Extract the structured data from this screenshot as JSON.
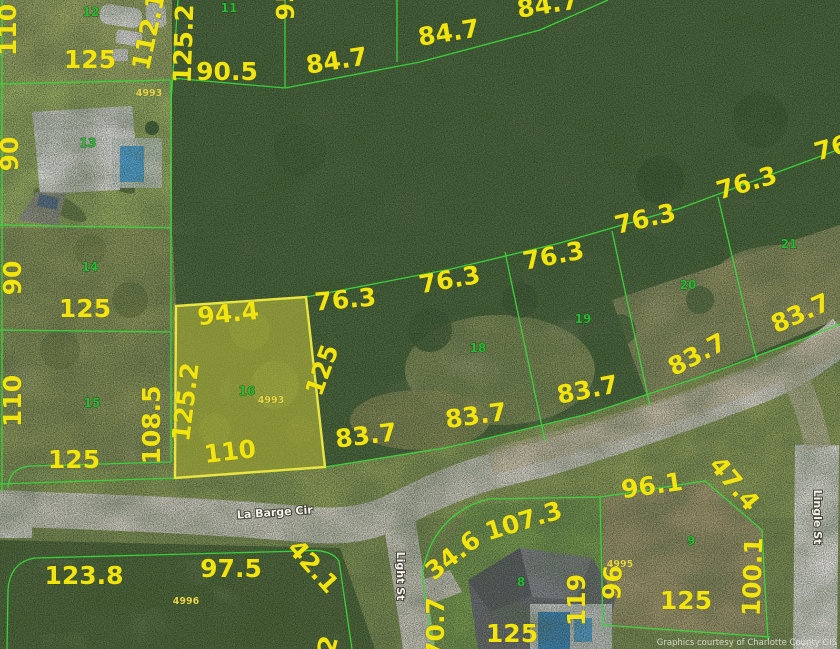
{
  "map": {
    "description": "County GIS aerial parcel map with lot dimension overlay",
    "watermark": "Graphics courtesy of Charlotte County GIS",
    "highlighted_parcel": {
      "parcel_number": "16",
      "lot_id": "4993"
    },
    "colors": {
      "boundary": "#3bd63b",
      "dimension_text": "#f2e40e",
      "lot_id_text": "#e6d84a",
      "parcel_number_text": "#2cb836",
      "street_text": "#f4f4ee",
      "highlight_fill": "rgba(235,229,62,0.42)",
      "highlight_stroke": "#e8e440"
    },
    "dimension_labels": [
      {
        "t": "110",
        "x": 16,
        "y": 30,
        "r": -90
      },
      {
        "t": "125",
        "x": 90,
        "y": 68,
        "r": 0
      },
      {
        "t": "112.1",
        "x": 157,
        "y": 33,
        "r": -78
      },
      {
        "t": "125.2",
        "x": 192,
        "y": 44,
        "r": -88
      },
      {
        "t": "90.5",
        "x": 227,
        "y": 80,
        "r": 0
      },
      {
        "t": "95",
        "x": 294,
        "y": 3,
        "r": -90
      },
      {
        "t": "84.7",
        "x": 338,
        "y": 69,
        "r": -9
      },
      {
        "t": "84.7",
        "x": 450,
        "y": 41,
        "r": -9
      },
      {
        "t": "84.7",
        "x": 549,
        "y": 13,
        "r": -9
      },
      {
        "t": "90",
        "x": 18,
        "y": 154,
        "r": -90
      },
      {
        "t": "90",
        "x": 21,
        "y": 278,
        "r": -90
      },
      {
        "t": "125",
        "x": 85,
        "y": 317,
        "r": 0
      },
      {
        "t": "110",
        "x": 21,
        "y": 401,
        "r": -90
      },
      {
        "t": "108.5",
        "x": 160,
        "y": 425,
        "r": -90
      },
      {
        "t": "125",
        "x": 74,
        "y": 468,
        "r": 0
      },
      {
        "t": "94.4",
        "x": 229,
        "y": 322,
        "r": -6
      },
      {
        "t": "125.2",
        "x": 194,
        "y": 403,
        "r": -83
      },
      {
        "t": "125",
        "x": 330,
        "y": 373,
        "r": -70
      },
      {
        "t": "110",
        "x": 231,
        "y": 460,
        "r": -7
      },
      {
        "t": "76.3",
        "x": 346,
        "y": 308,
        "r": -5
      },
      {
        "t": "76.3",
        "x": 451,
        "y": 288,
        "r": -10
      },
      {
        "t": "76.3",
        "x": 555,
        "y": 264,
        "r": -11
      },
      {
        "t": "76.3",
        "x": 647,
        "y": 227,
        "r": -13
      },
      {
        "t": "76.3",
        "x": 749,
        "y": 191,
        "r": -16
      },
      {
        "t": "76",
        "x": 834,
        "y": 156,
        "r": -16
      },
      {
        "t": "83.7",
        "x": 367,
        "y": 444,
        "r": -7
      },
      {
        "t": "83.7",
        "x": 477,
        "y": 424,
        "r": -8
      },
      {
        "t": "83.7",
        "x": 589,
        "y": 398,
        "r": -11
      },
      {
        "t": "83.7",
        "x": 701,
        "y": 362,
        "r": -28
      },
      {
        "t": "83.7",
        "x": 804,
        "y": 321,
        "r": -24
      },
      {
        "t": "123.8",
        "x": 84,
        "y": 584,
        "r": 0
      },
      {
        "t": "97.5",
        "x": 231,
        "y": 577,
        "r": 0
      },
      {
        "t": "42.1",
        "x": 307,
        "y": 572,
        "r": 48
      },
      {
        "t": "2",
        "x": 336,
        "y": 647,
        "r": -75
      },
      {
        "t": "34.6",
        "x": 458,
        "y": 562,
        "r": -38
      },
      {
        "t": "70.7",
        "x": 444,
        "y": 628,
        "r": -90
      },
      {
        "t": "107.3",
        "x": 526,
        "y": 529,
        "r": -17
      },
      {
        "t": "96.1",
        "x": 653,
        "y": 494,
        "r": -8
      },
      {
        "t": "47.4",
        "x": 728,
        "y": 489,
        "r": 50
      },
      {
        "t": "119",
        "x": 585,
        "y": 600,
        "r": -90
      },
      {
        "t": "96",
        "x": 621,
        "y": 583,
        "r": -87
      },
      {
        "t": "100.1",
        "x": 761,
        "y": 577,
        "r": -88
      },
      {
        "t": "125",
        "x": 686,
        "y": 609,
        "r": 0
      },
      {
        "t": "125",
        "x": 512,
        "y": 642,
        "r": 0
      }
    ],
    "lot_id_labels": [
      {
        "t": "4993",
        "x": 149,
        "y": 96
      },
      {
        "t": "4993",
        "x": 271,
        "y": 403
      },
      {
        "t": "4996",
        "x": 186,
        "y": 604
      },
      {
        "t": "4995",
        "x": 620,
        "y": 567
      }
    ],
    "parcel_number_labels": [
      {
        "t": "12",
        "x": 91,
        "y": 16
      },
      {
        "t": "11",
        "x": 229,
        "y": 12
      },
      {
        "t": "13",
        "x": 88,
        "y": 147
      },
      {
        "t": "14",
        "x": 90,
        "y": 271
      },
      {
        "t": "15",
        "x": 92,
        "y": 407
      },
      {
        "t": "16",
        "x": 247,
        "y": 395
      },
      {
        "t": "18",
        "x": 478,
        "y": 352
      },
      {
        "t": "19",
        "x": 583,
        "y": 323
      },
      {
        "t": "20",
        "x": 688,
        "y": 289
      },
      {
        "t": "21",
        "x": 789,
        "y": 248
      },
      {
        "t": "8",
        "x": 521,
        "y": 586
      },
      {
        "t": "9",
        "x": 691,
        "y": 545
      }
    ],
    "street_labels": [
      {
        "t": "La Barge Cir",
        "x": 275,
        "y": 516,
        "r": -4
      },
      {
        "t": "Light St",
        "x": 397,
        "y": 576,
        "r": 90
      },
      {
        "t": "Lingle St",
        "x": 814,
        "y": 517,
        "r": 90
      }
    ]
  }
}
